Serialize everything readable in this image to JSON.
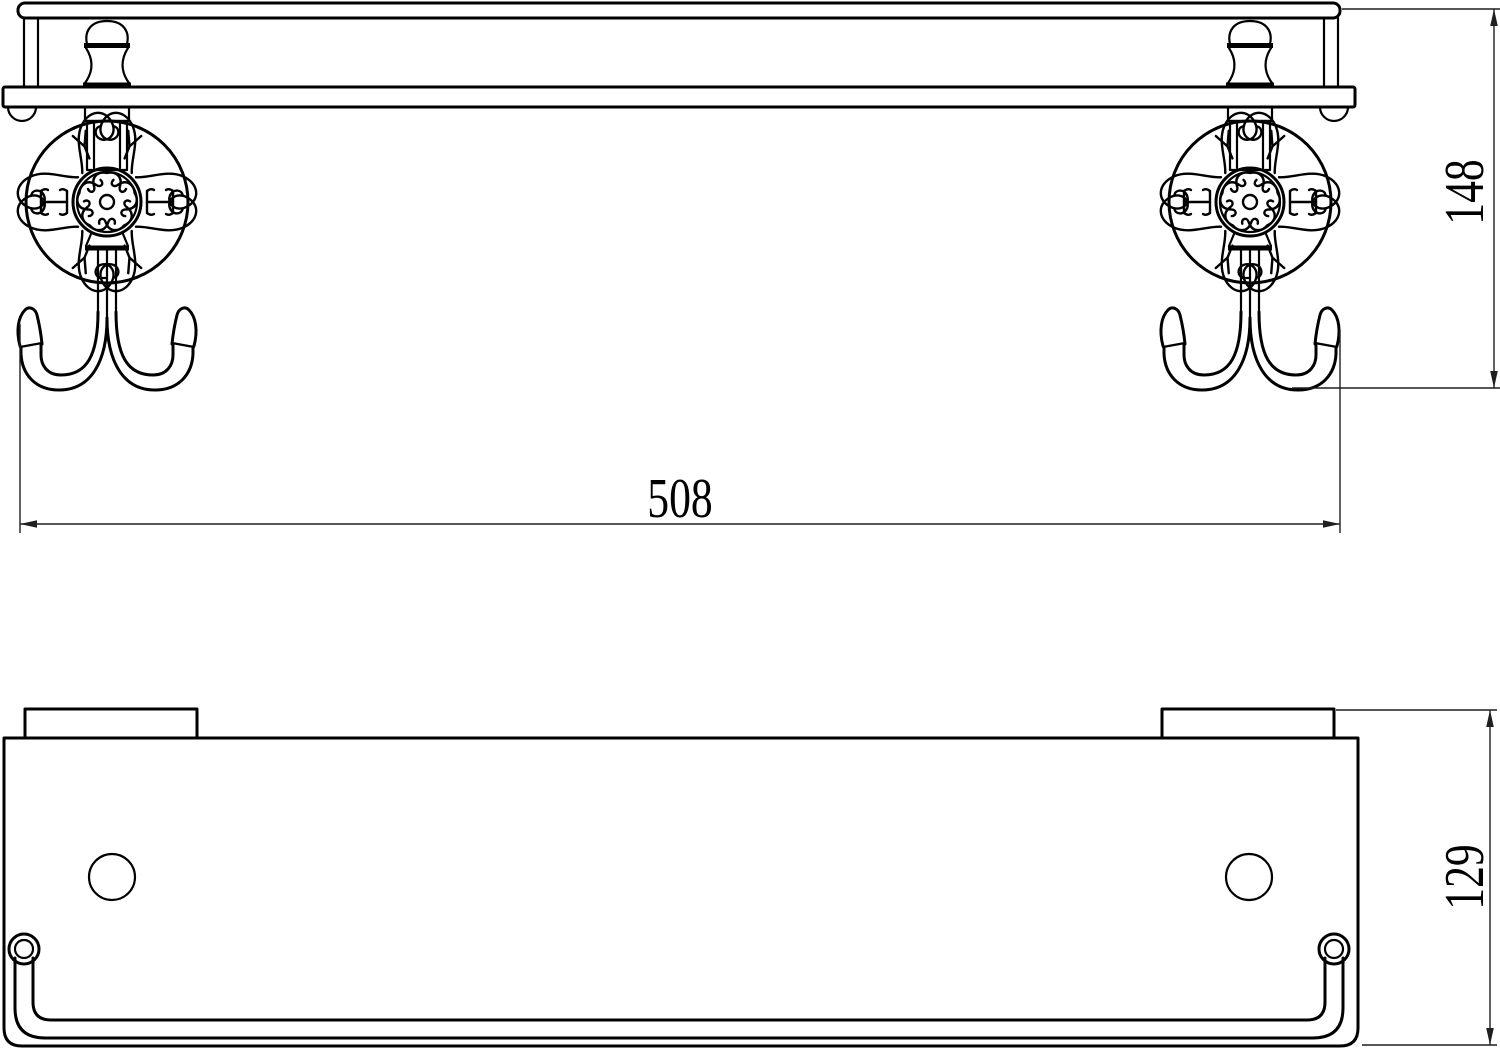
{
  "drawing": {
    "type": "technical-drawing",
    "subject": "wall-mounted shelf with rail and double robe hooks, two orthographic views",
    "colors": {
      "background": "#ffffff",
      "object_lines": "#000000",
      "dimension_lines": "#1f1f1f",
      "text": "#000000"
    },
    "views": {
      "front_elevation": {
        "features": [
          "top-rail",
          "rail-posts",
          "shelf-plate",
          "ornamental-rosette-mounts",
          "double-hooks"
        ]
      },
      "top_plan": {
        "features": [
          "shelf-plate",
          "wall-bracket-tabs",
          "mounting-holes",
          "front-rail-with-post-rings"
        ]
      }
    },
    "dimensions": {
      "width": {
        "value": "508",
        "orientation": "horizontal",
        "applies_to": "overall width across hooks"
      },
      "height": {
        "value": "148",
        "orientation": "vertical",
        "applies_to": "rail top to hook bottom"
      },
      "depth": {
        "value": "129",
        "orientation": "vertical",
        "applies_to": "overall depth of shelf in plan"
      }
    }
  }
}
